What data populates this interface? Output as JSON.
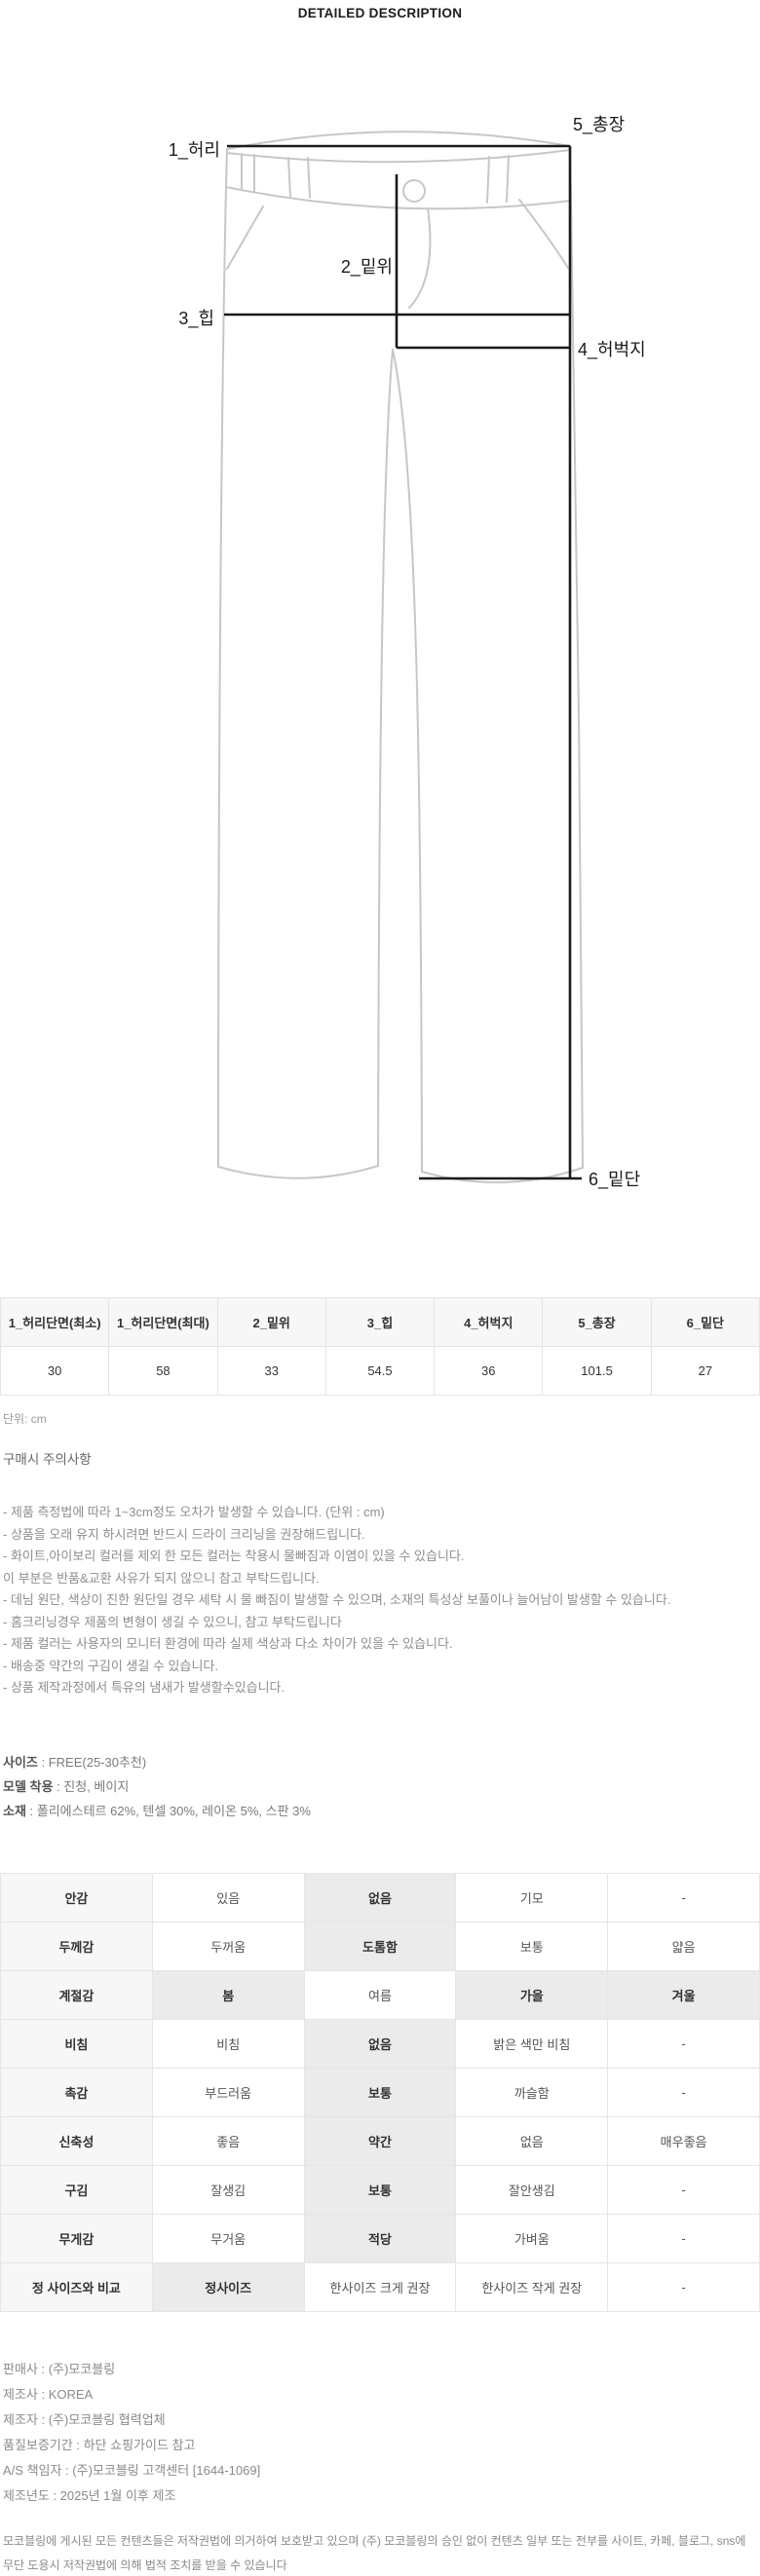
{
  "page": {
    "title": "DETAILED DESCRIPTION"
  },
  "diagram": {
    "labels": {
      "waist": "1_허리",
      "rise": "2_밑위",
      "hip": "3_힙",
      "thigh": "4_허벅지",
      "length": "5_총장",
      "hem": "6_밑단"
    }
  },
  "size_table": {
    "headers": [
      "1_허리단면(최소)",
      "1_허리단면(최대)",
      "2_밑위",
      "3_힙",
      "4_허벅지",
      "5_총장",
      "6_밑단"
    ],
    "values": [
      "30",
      "58",
      "33",
      "54.5",
      "36",
      "101.5",
      "27"
    ],
    "unit_note": "단위: cm"
  },
  "purchase_notes": {
    "title": "구매시 주의사항",
    "lines": [
      "- 제품 측정법에 따라 1~3cm정도 오차가 발생할 수 있습니다. (단위 : cm)",
      "- 상품을 오래 유지 하시려면 반드시 드라이 크리닝을 권장해드립니다.",
      "- 화이트,아이보리 컬러를 제외 한 모든 컬러는 착용시 물빠짐과 이염이 있을 수 있습니다.",
      "이 부분은 반품&교환 사유가 되지 않으니 참고 부탁드립니다.",
      "- 데님 원단, 색상이 진한 원단일 경우 세탁 시 물 빠짐이 발생할 수 있으며, 소재의 특성상 보풀이나 늘어남이 발생할 수 있습니다.",
      "- 홈크리닝경우 제품의 변형이 생길 수 있으니, 참고 부탁드립니다",
      "- 제품 컬러는 사용자의 모니터 환경에 따라 실제 색상과 다소 차이가 있을 수 있습니다.",
      "- 배송중 약간의 구김이 생길 수 있습니다.",
      "- 상품 제작과정에서 특유의 냄새가 발생할수있습니다."
    ]
  },
  "product_info": {
    "lines": [
      {
        "label": "사이즈",
        "value": " : FREE(25-30추천)"
      },
      {
        "label": "모델 착용",
        "value": " : 진청, 베이지"
      },
      {
        "label": "소재",
        "value": " : 폴리에스테르 62%, 텐셀 30%, 레이온 5%, 스판 3%"
      }
    ]
  },
  "feature_table": {
    "rows": [
      {
        "label": "안감",
        "options": [
          {
            "text": "있음",
            "selected": false
          },
          {
            "text": "없음",
            "selected": true
          },
          {
            "text": "기모",
            "selected": false
          },
          {
            "text": "-",
            "selected": false
          }
        ]
      },
      {
        "label": "두께감",
        "options": [
          {
            "text": "두꺼움",
            "selected": false
          },
          {
            "text": "도톰함",
            "selected": true
          },
          {
            "text": "보통",
            "selected": false
          },
          {
            "text": "얇음",
            "selected": false
          }
        ]
      },
      {
        "label": "계절감",
        "options": [
          {
            "text": "봄",
            "selected": true
          },
          {
            "text": "여름",
            "selected": false
          },
          {
            "text": "가을",
            "selected": true
          },
          {
            "text": "겨울",
            "selected": true
          }
        ]
      },
      {
        "label": "비침",
        "options": [
          {
            "text": "비침",
            "selected": false
          },
          {
            "text": "없음",
            "selected": true
          },
          {
            "text": "밝은 색만 비침",
            "selected": false
          },
          {
            "text": "-",
            "selected": false
          }
        ]
      },
      {
        "label": "촉감",
        "options": [
          {
            "text": "부드러움",
            "selected": false
          },
          {
            "text": "보통",
            "selected": true
          },
          {
            "text": "까슬함",
            "selected": false
          },
          {
            "text": "-",
            "selected": false
          }
        ]
      },
      {
        "label": "신축성",
        "options": [
          {
            "text": "좋음",
            "selected": false
          },
          {
            "text": "약간",
            "selected": true
          },
          {
            "text": "없음",
            "selected": false
          },
          {
            "text": "매우좋음",
            "selected": false
          }
        ]
      },
      {
        "label": "구김",
        "options": [
          {
            "text": "잘생김",
            "selected": false
          },
          {
            "text": "보통",
            "selected": true
          },
          {
            "text": "잘안생김",
            "selected": false
          },
          {
            "text": "-",
            "selected": false
          }
        ]
      },
      {
        "label": "무게감",
        "options": [
          {
            "text": "무거움",
            "selected": false
          },
          {
            "text": "적당",
            "selected": true
          },
          {
            "text": "가벼움",
            "selected": false
          },
          {
            "text": "-",
            "selected": false
          }
        ]
      },
      {
        "label": "정 사이즈와 비교",
        "options": [
          {
            "text": "정사이즈",
            "selected": true
          },
          {
            "text": "한사이즈 크게 권장",
            "selected": false
          },
          {
            "text": "한사이즈 작게 권장",
            "selected": false
          },
          {
            "text": "-",
            "selected": false
          }
        ]
      }
    ]
  },
  "seller_info": {
    "lines": [
      "판매사 : (주)모코블링",
      "제조사 : KOREA",
      "제조자 : (주)모코블링 협력업체",
      "품질보증기간 : 하단 쇼핑가이드 참고",
      "A/S 책임자 : (주)모코블링 고객센터 [1644-1069]",
      "제조년도 : 2025년 1월 이후 제조"
    ]
  },
  "copyright": "모코블링에 게시된 모든 컨텐츠들은 저작권법에 의거하여 보호받고 있으며 (주) 모코블링의 승인 없이 컨텐츠 일부 또는 전부를 사이트, 카페, 블로그, sns에 무단 도용시 저작권법에 의해 법적 조치를 받을 수 있습니다",
  "colors": {
    "table_header_bg": "#f7f7f7",
    "selected_cell_bg": "#ebebeb",
    "outline_gray": "#c7c7c7"
  }
}
